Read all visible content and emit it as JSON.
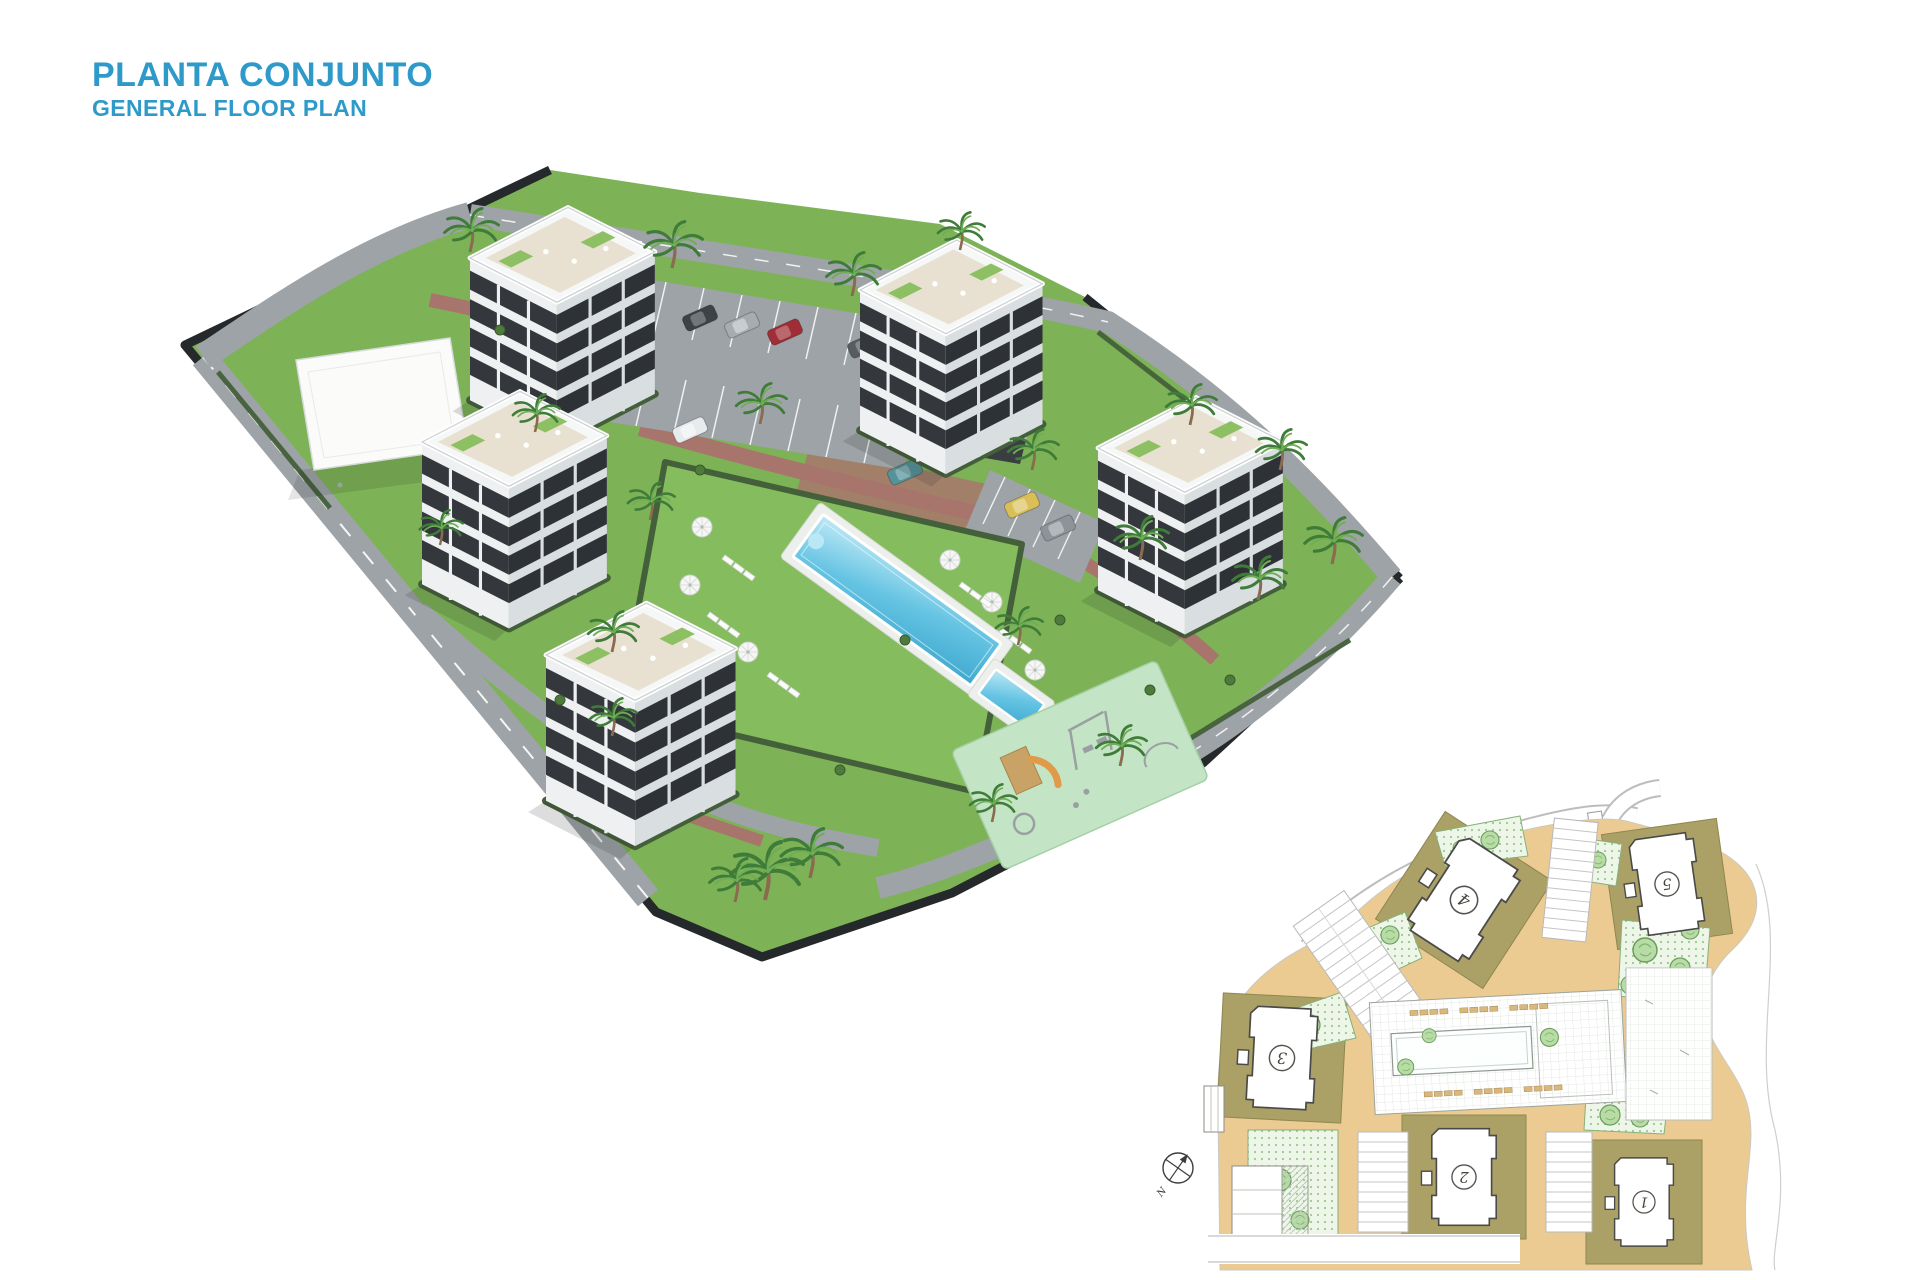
{
  "header": {
    "title": "PLANTA CONJUNTO",
    "subtitle": "GENERAL FLOOR PLAN"
  },
  "inset": {
    "north_label": "N",
    "buildings": [
      {
        "label": "1"
      },
      {
        "label": "2"
      },
      {
        "label": "3"
      },
      {
        "label": "4"
      },
      {
        "label": "5"
      }
    ]
  },
  "colors": {
    "title_blue": "#2E9AC9",
    "grass": "#7DB356",
    "pool_lawn": "#85BC5D",
    "asphalt": "#9EA3A7",
    "boundary_dark": "#26292C",
    "brick_path": "#A8756C",
    "playground_mint": "#C3E5C5",
    "pool_water": "#66C4E3",
    "building_white": "#F6F7F7",
    "plan_road_tan": "#ECCB93",
    "plan_plot_olive": "#ABA065",
    "plan_landscape": "#EDF6E8"
  }
}
